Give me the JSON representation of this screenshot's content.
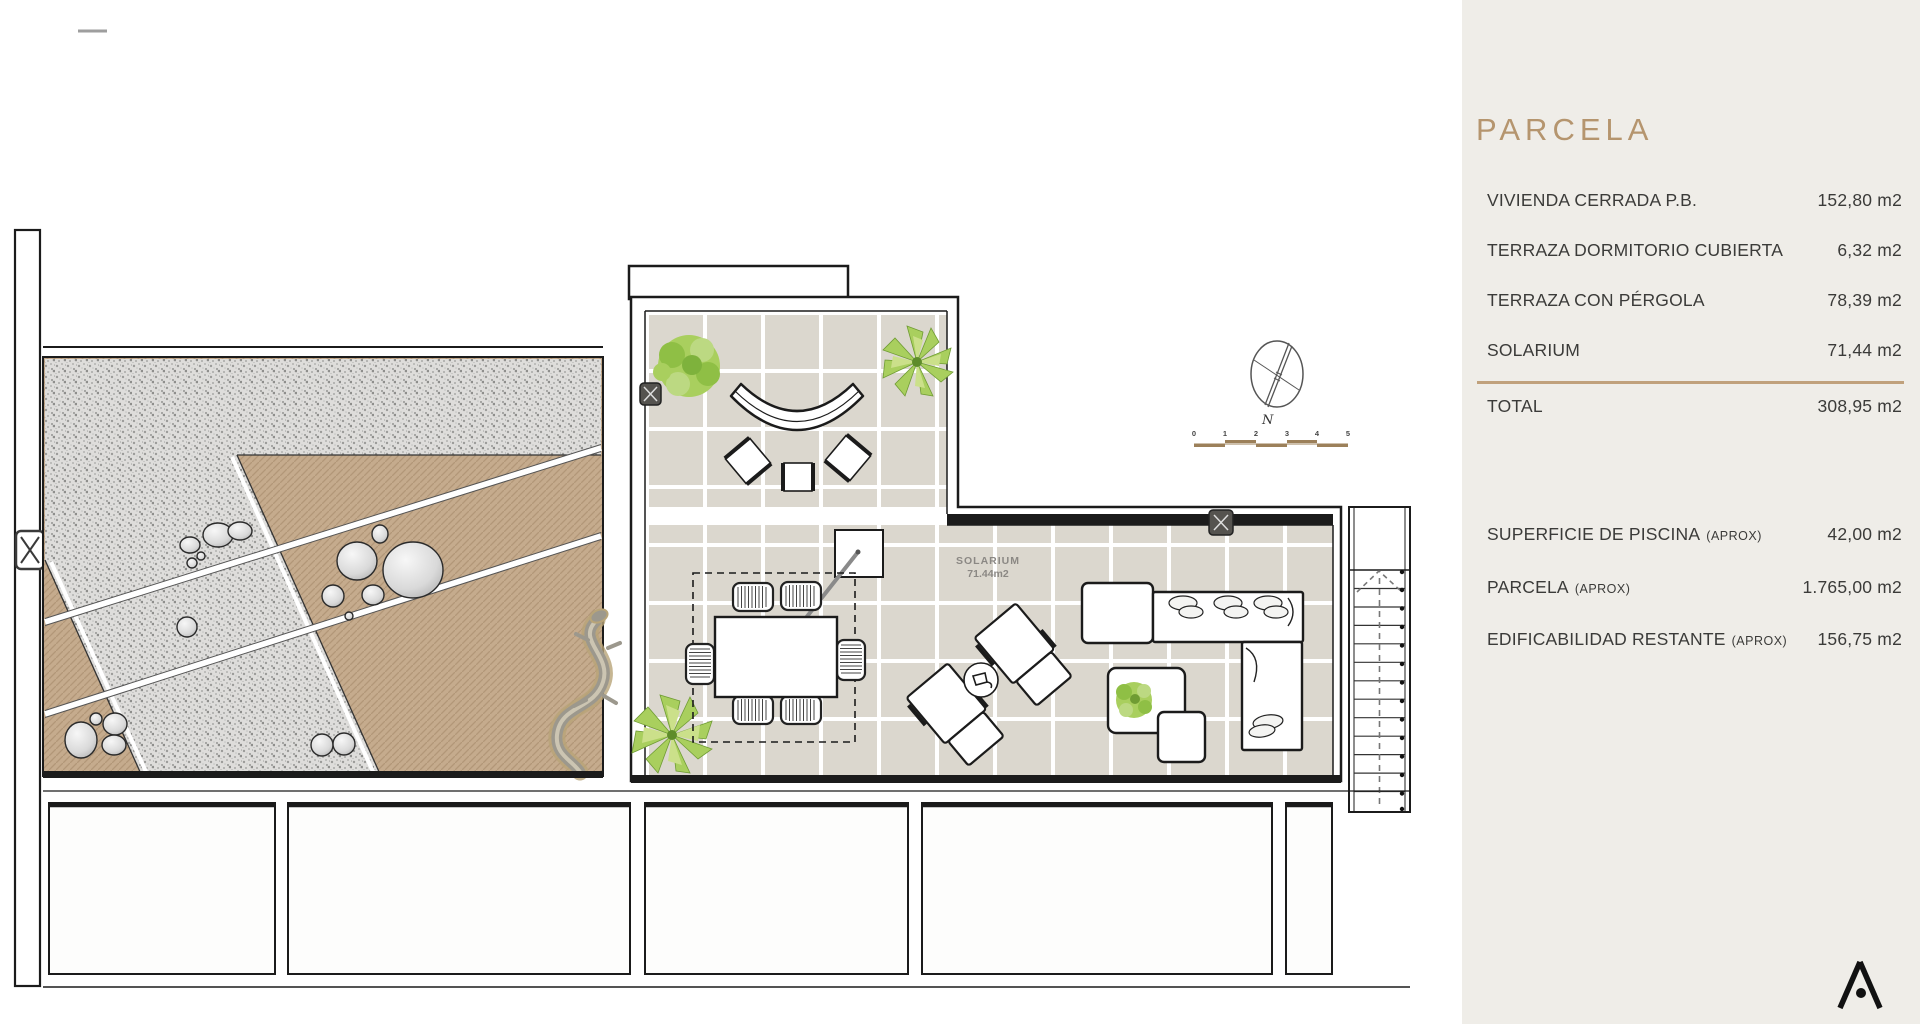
{
  "sidebar": {
    "title": "PARCELA",
    "parcela_rows": [
      {
        "label": "VIVIENDA CERRADA P.B.",
        "value": "152,80 m2"
      },
      {
        "label": "TERRAZA DORMITORIO CUBIERTA",
        "value": "6,32 m2"
      },
      {
        "label": "TERRAZA CON PÉRGOLA",
        "value": "78,39 m2"
      },
      {
        "label": "SOLARIUM",
        "value": "71,44 m2"
      }
    ],
    "total": {
      "label": "TOTAL",
      "value": "308,95 m2"
    },
    "aprox_rows": [
      {
        "label": "SUPERFICIE DE PISCINA",
        "suffix": "(APROX)",
        "value": "42,00 m2"
      },
      {
        "label": "PARCELA",
        "suffix": "(APROX)",
        "value": "1.765,00 m2"
      },
      {
        "label": "EDIFICABILIDAD RESTANTE",
        "suffix": "(APROX)",
        "value": "156,75 m2"
      }
    ]
  },
  "plan": {
    "solarium_label": "SOLARIUM",
    "solarium_area": "71.44m2",
    "north_label": "N",
    "scale_ticks": [
      "0",
      "1",
      "2",
      "3",
      "4",
      "5"
    ]
  },
  "colors": {
    "accent": "#b5956e",
    "sidebar_bg": "#efede8",
    "divider": "#c0a17c",
    "tile": "#dbd7ce",
    "sand": "#c5ab8d",
    "line": "#1b1b1b",
    "scalebar": "#9c805a"
  }
}
